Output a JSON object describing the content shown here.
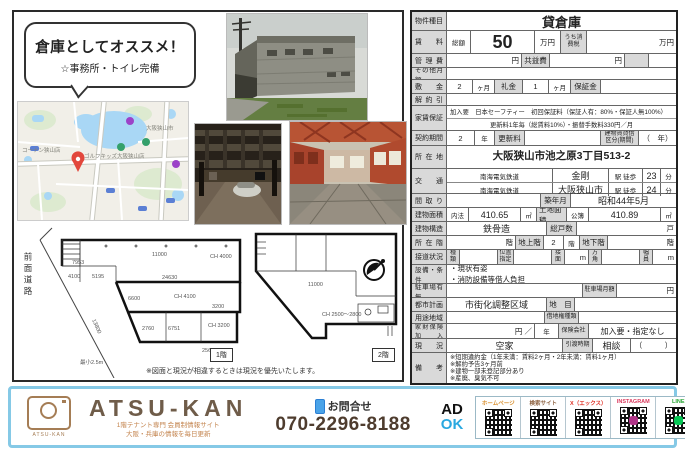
{
  "bubble": {
    "line1": "倉庫としてオススメ！",
    "line2": "☆事務所・トイレ完備"
  },
  "plans": {
    "front_road": "前面道路",
    "floor1_label": "1階",
    "floor2_label": "2階",
    "min_width": "最小2.5m",
    "note": "※図面と現況が相違するときは現況を優先いたします。",
    "plan1_dims": [
      "7953",
      "11000",
      "CH 4000",
      "24630",
      "4100",
      "5195",
      "6600",
      "CH 4100",
      "13800",
      "2760",
      "6751",
      "3200",
      "25600",
      "CH 3200"
    ],
    "plan2_dims": [
      "11000",
      "CH 2500～2800"
    ]
  },
  "map": {
    "labels": [
      "コーナン狭山店",
      "ゴルフキッズ大阪狭山店",
      "大阪狭山市"
    ]
  },
  "table": {
    "property_type": {
      "label": "物件種目",
      "value": "貸倉庫"
    },
    "rent": {
      "label": "賃料",
      "total_label": "総額",
      "amount": "50",
      "unit": "万円",
      "tax_label": "うち消費税",
      "tax_unit": "万円"
    },
    "kanrihi": {
      "label": "管理費",
      "unit1": "円",
      "kyoueki_label": "共益費",
      "unit2": "円"
    },
    "sonota": {
      "label": "その他月額"
    },
    "shikikin": {
      "label": "敷金",
      "v1": "2",
      "u1": "ヶ月",
      "rei_label": "礼金",
      "v2": "1",
      "u2": "ヶ月",
      "hoshou_label": "保証金"
    },
    "kaiyaku": {
      "label": "解約引"
    },
    "hoshou": {
      "label": "家賃保証",
      "line1": "加入要　日本セーフティー　初回保証料（保証人有：80%・保証人無100%）",
      "line2": "更新料1年毎（総賃料10%）・振替手数料330円／月"
    },
    "keiyaku": {
      "label": "契約期間",
      "v": "2",
      "u": "年",
      "koushin_label": "更新料",
      "kubun_label": "建物賃貸借区分(期間)",
      "kubun_value": "（　年）"
    },
    "address": {
      "label": "所在地",
      "value": "大阪狭山市池之原3丁目513-2"
    },
    "access": {
      "label": "交通",
      "line1": {
        "company": "南海電気鉄道",
        "station": "金剛",
        "walk": "駅 徒歩",
        "min": "23",
        "unit": "分"
      },
      "line2": {
        "company": "南海電気鉄道",
        "station": "大阪狭山市",
        "walk": "駅 徒歩",
        "min": "24",
        "unit": "分"
      }
    },
    "madori": {
      "label": "間取り",
      "chikunen_label": "築年月",
      "chikunen_value": "昭和44年5月"
    },
    "menseki": {
      "label": "建物面積",
      "v1_label": "内法",
      "v1": "410.65",
      "v1_unit": "㎡",
      "tochi_label": "土地面積",
      "v2_label": "公簿",
      "v2": "410.89",
      "v2_unit": "㎡"
    },
    "kouzou": {
      "label": "建物構造",
      "value": "鉄骨造",
      "soukosu_label": "総戸数",
      "soukosu_unit": "戸"
    },
    "shozaikai": {
      "label": "所在階",
      "u1": "階",
      "chijou_label": "地上階",
      "chijou": "2",
      "u2": "階",
      "chika_label": "地下階",
      "u3": "階"
    },
    "setsudou": {
      "label": "接道状況",
      "shurui": "種類",
      "ichi": "位置指定",
      "setsumen": "接面",
      "m1": "m",
      "hougaku": "方角",
      "fukuin": "幅員",
      "m2": "m"
    },
    "setsubi": {
      "label": "設備・条件",
      "line1": "・現状有姿",
      "line2": "・消防設備等借人負担"
    },
    "parking": {
      "label": "駐車場有無",
      "monthly_label": "駐車場月額",
      "unit": "円"
    },
    "toshi": {
      "label": "都市計画",
      "value": "市街化調整区域",
      "chimoku_label": "地　目"
    },
    "youto": {
      "label": "用途地域",
      "shakuchi_label": "借地権種類"
    },
    "kazai": {
      "label": "家財保険加入",
      "unit": "円 ／",
      "u2": "年",
      "hoken_label": "保険会社",
      "value": "加入要・指定なし"
    },
    "genkyou": {
      "label": "現況",
      "value": "空家",
      "hikiwatashi_label": "引渡時期",
      "hikiwatashi_value": "相談",
      "paren": "（　　　）"
    },
    "bikou": {
      "label": "備考",
      "lines": [
        "※短期違約金（1年未満：賃料2ヶ月・2年未満：賃料1ヶ月）",
        "※解約予告3ヶ月前",
        "※建物一部未登記部分あり",
        "※産廃、臭気不可"
      ]
    }
  },
  "footer": {
    "brand": "ATSU-KAN",
    "logo_caption": "ATSU-KAN",
    "tagline1": "1階テナント専門 会員制情報サイト",
    "tagline2": "大阪・兵庫の情報を毎日更新",
    "contact_label": "お問合せ",
    "phone": "070-2296-8188",
    "ad": "AD",
    "ok": "OK",
    "qr": [
      {
        "label": "ホームページ",
        "color": "#d9902f"
      },
      {
        "label": "検索サイト",
        "color": "#8b5e3c"
      },
      {
        "label": "X（エックス）",
        "color": "#e03226"
      },
      {
        "label": "INSTAGRAM",
        "color": "#d93a5e",
        "center": "#b13589"
      },
      {
        "label": "LINE",
        "color": "#27a433",
        "center": "#06c755"
      }
    ]
  }
}
